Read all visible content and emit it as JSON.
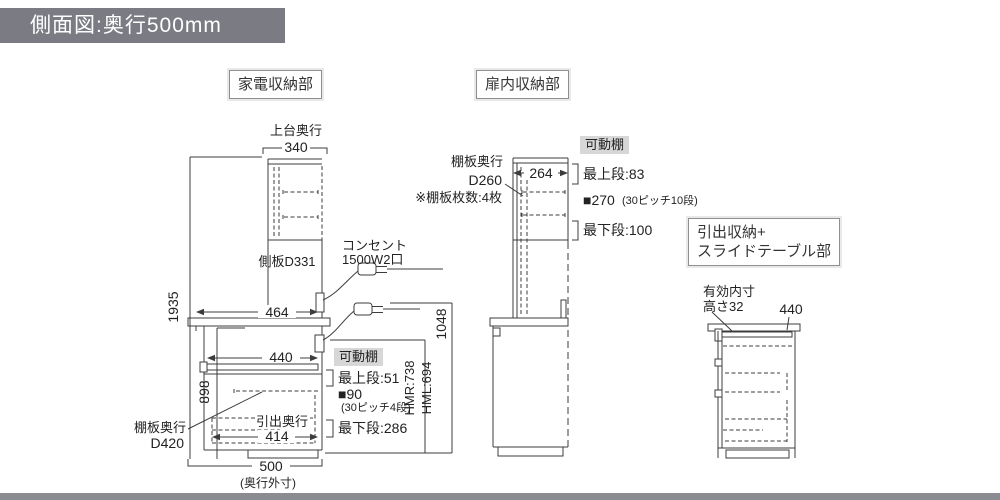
{
  "title": "側面図:奥行500mm",
  "sections": {
    "appliance_label": "家電収納部",
    "door_label": "扉内収納部",
    "drawer_label_line1": "引出収納+",
    "drawer_label_line2": "スライドテーブル部"
  },
  "left_unit": {
    "top_depth_caption": "上台奥行",
    "top_depth": "340",
    "side_panel": "側板D331",
    "total_height": "1935",
    "base_height": "898",
    "counter_depth": "464",
    "open_space_width": "440",
    "outlet_caption": "コンセント",
    "outlet_spec": "1500W2口",
    "movable_shelf_tag": "可動棚",
    "shelf_top_step": "最上段:51",
    "shelf_pitch": "■90",
    "shelf_pitch_note": "(30ピッチ4段)",
    "shelf_bottom_step": "最下段:286",
    "hmr": "HMR:738",
    "hml": "HML:694",
    "counter_top_height": "1048",
    "shelf_depth_caption": "棚板奥行",
    "shelf_depth": "D420",
    "drawer_depth_caption": "引出奥行",
    "drawer_depth": "414",
    "outer_depth": "500",
    "outer_depth_note": "(奥行外寸)"
  },
  "middle_unit": {
    "shelf_depth_caption": "棚板奥行",
    "shelf_depth": "D260",
    "shelf_count_note": "※棚板枚数:4枚",
    "inner_depth": "264",
    "movable_shelf_tag": "可動棚",
    "shelf_top_step": "最上段:83",
    "shelf_pitch": "■270",
    "shelf_pitch_note": "(30ピッチ10段)",
    "shelf_bottom_step": "最下段:100"
  },
  "right_unit": {
    "inner_caption": "有効内寸",
    "inner_height": "高さ32",
    "table_width": "440"
  },
  "colors": {
    "title_bar_bg": "#7b7b84",
    "footer_bar": "#8b8b92",
    "tag_bg": "#d7d7d7",
    "line": "#3c3c3c"
  }
}
